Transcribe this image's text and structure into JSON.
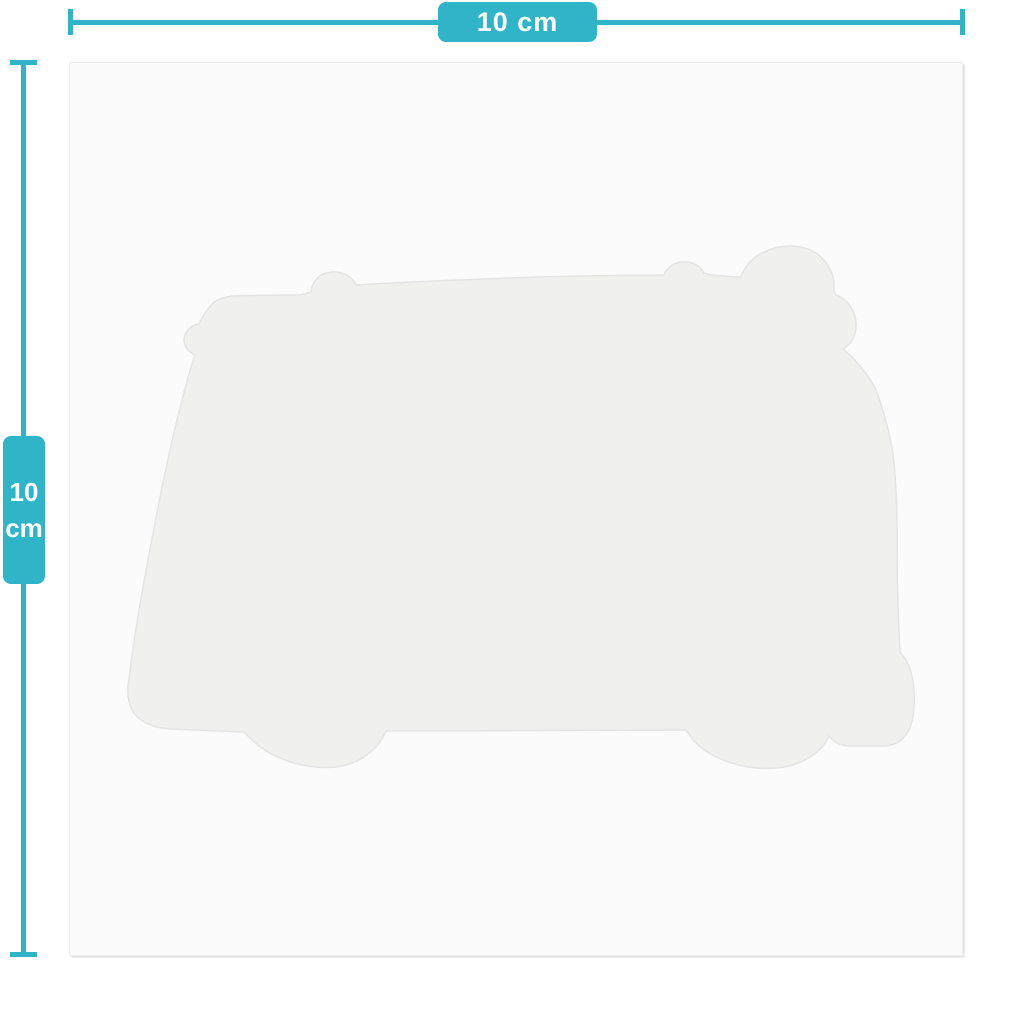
{
  "dimensions": {
    "horizontal": {
      "label": "10 cm"
    },
    "vertical": {
      "value": "10",
      "unit": "cm"
    }
  },
  "icons": {
    "silhouette": "campervan-with-surfboard-silhouette"
  },
  "colors": {
    "accent": "#2fb4c8",
    "canvas_bg": "#ffffff",
    "card_bg": "#fbfbfb",
    "card_border": "#ececec",
    "silhouette_fill": "#f0f0ef",
    "silhouette_stroke": "#e3e4e4",
    "label_text": "#ffffff"
  }
}
